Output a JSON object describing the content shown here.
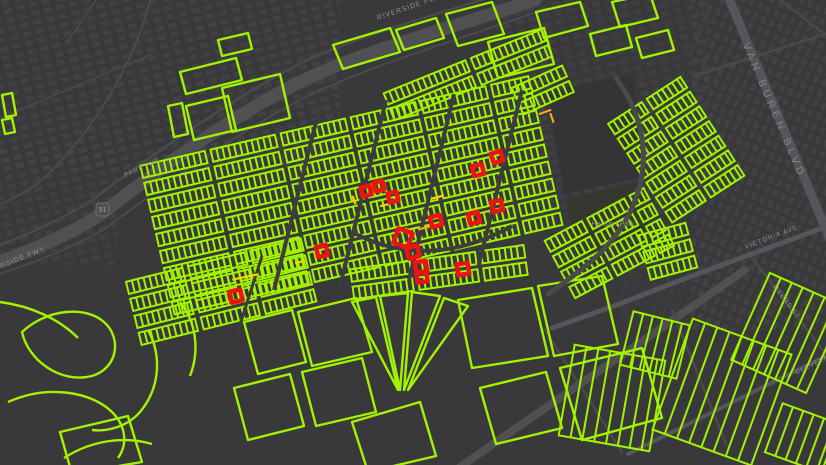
{
  "map": {
    "width": 826,
    "height": 465,
    "colors": {
      "bg": "#39393b",
      "road": "#4a4a4c",
      "freeway": "#505053",
      "arterial": "#55555a",
      "dark_street": "#3d3d3f",
      "building": "#444447",
      "school_patch": "#343436",
      "park_patch": "#36382f",
      "green": "#a2f300",
      "red": "#ee1212",
      "yellow": "#ffd400",
      "orange": "#ffa31a",
      "label": "#8f8f91",
      "label_road_major": "#86868a",
      "label_park": "#87907f",
      "shield_fill": "#4f4f52",
      "shield_stroke": "#6e6e71",
      "shield_text": "#a0a0a2"
    },
    "building_zones": [
      {
        "x": 0,
        "y": 0,
        "w": 340,
        "h": 170,
        "p": 1,
        "o": 0.75
      },
      {
        "x": 0,
        "y": 150,
        "w": 118,
        "h": 115,
        "p": 1,
        "o": 0.6
      },
      {
        "x": 495,
        "y": 0,
        "w": 215,
        "h": 125,
        "p": 1,
        "o": 0.5
      },
      {
        "x": 540,
        "y": 85,
        "w": 125,
        "h": 130,
        "p": 1,
        "o": 0.5
      },
      {
        "x": 692,
        "y": 0,
        "w": 134,
        "h": 330,
        "p": 2,
        "o": 0.7
      },
      {
        "x": 620,
        "y": 240,
        "w": 100,
        "h": 90,
        "p": 2,
        "o": 0.4
      }
    ],
    "dark_patches": [
      {
        "pts": "548,92 632,74 648,176 564,194",
        "c": "school_patch"
      },
      {
        "pts": "566,198 640,182 652,240 578,256",
        "c": "park_patch"
      }
    ],
    "roads": [
      {
        "name": "riverside-fwy",
        "d": "M535,0 C460,25 360,52 300,82 C240,112 170,160 100,215 C60,240 25,252 0,262",
        "w": 13,
        "c": "freeway"
      },
      {
        "name": "park-ave",
        "d": "M520,-12 C450,10 350,38 295,66 C238,96 165,145 92,200 C55,224 22,236 0,245",
        "w": 2.5,
        "c": "road"
      },
      {
        "name": "fwy-south-frontage",
        "d": "M548,8 C470,36 368,66 308,96 C248,126 178,174 106,228 C66,252 28,264 0,274",
        "w": 2,
        "c": "road"
      },
      {
        "name": "van-buren-blvd",
        "d": "M727,-6 L838,258",
        "w": 9,
        "c": "arterial"
      },
      {
        "name": "victoria-ave",
        "d": "M838,222 C770,248 700,272 640,296 C610,308 580,318 552,328",
        "w": 5,
        "c": "arterial"
      },
      {
        "name": "myers-st",
        "d": "M752,258 L838,370",
        "w": 2.5,
        "c": "road"
      },
      {
        "name": "cleveland-ave",
        "d": "M628,454 L838,350",
        "w": 4,
        "c": "arterial"
      },
      {
        "name": "canal-road",
        "d": "M745,270 L460,467",
        "w": 8,
        "c": "freeway"
      },
      {
        "name": "minor-1",
        "d": "M0,118 L150,55",
        "w": 1.5,
        "c": "road"
      },
      {
        "name": "minor-2",
        "d": "M150,0 C136,58 100,120 56,166 C36,188 16,198 0,204",
        "w": 2,
        "c": "road"
      },
      {
        "name": "minor-3",
        "d": "M96,0 L66,44",
        "w": 1.5,
        "c": "road"
      },
      {
        "name": "minor-4",
        "d": "M694,76 L838,30",
        "w": 2.5,
        "c": "road"
      },
      {
        "name": "minor-5",
        "d": "M780,0 L838,44",
        "w": 2,
        "c": "road"
      },
      {
        "name": "minor-6",
        "d": "M545,330 L622,452",
        "w": 2.5,
        "c": "road"
      },
      {
        "name": "minor-7",
        "d": "M672,310 L726,444",
        "w": 2.5,
        "c": "road"
      }
    ],
    "green": {
      "curves": [
        "M22,332 C48,308 86,306 104,322 C122,338 118,368 92,376 C60,384 28,360 22,332 Z",
        "M0,302 C30,306 58,318 78,338",
        "M8,402 C48,384 92,392 112,412 C126,426 128,444 118,458",
        "M64,458 C92,440 124,436 152,444",
        "M148,330 C162,356 160,388 140,412 C128,426 108,432 92,430",
        "M180,302 C196,322 200,350 190,376"
      ],
      "plots": [
        "333,45 390,28 400,52 343,69",
        "396,30 436,18 444,38 404,50",
        "446,14 492,2 504,34 458,46",
        "488,42 544,28 554,64 498,78",
        "536,12 580,2 588,26 544,38",
        "590,34 626,25 632,47 596,56",
        "612,2 650,-6 658,18 620,27",
        "636,38 668,30 674,50 642,58",
        "222,88 280,74 290,118 232,132",
        "180,72 236,58 242,80 186,94",
        "218,40 248,33 252,49 222,56",
        "186,106 228,96 236,130 194,140",
        "168,106 182,103 188,134 174,137",
        "2,95 12,93 16,115 6,117",
        "2,120 12,118 15,132 5,134",
        "352,302 376,297 398,390",
        "380,296 408,293 400,390",
        "412,292 440,296 404,390",
        "444,298 468,306 408,390",
        "458,300 532,288 548,356 472,368",
        "538,286 602,276 618,344 554,356",
        "560,368 642,348 662,418 582,440",
        "480,388 546,372 562,428 496,444",
        "298,312 356,298 372,352 312,366",
        "244,322 292,310 306,362 258,374",
        "302,372 362,358 376,412 316,426",
        "234,388 290,374 304,426 248,440",
        "352,422 420,402 436,456 368,472",
        "60,432 128,416 142,462 72,474"
      ],
      "combs": [
        {
          "x": 470,
          "y": 80,
          "w": 170,
          "h": 40,
          "a": -22,
          "rh": 12,
          "rg": 6,
          "sl": 88
        },
        {
          "x": 545,
          "y": 95,
          "w": 55,
          "h": 40,
          "a": -24,
          "rh": 12,
          "rg": 6,
          "sl": 55
        },
        {
          "x": 352,
          "y": 198,
          "w": 398,
          "h": 158,
          "a": -13,
          "rh": 12.5,
          "rg": 6,
          "sl": 66
        },
        {
          "x": 222,
          "y": 295,
          "w": 180,
          "h": 72,
          "a": -14,
          "rh": 12.5,
          "rg": 6,
          "sl": 58
        },
        {
          "x": 440,
          "y": 280,
          "w": 175,
          "h": 46,
          "a": -8,
          "rh": 12.5,
          "rg": 6,
          "sl": 60
        },
        {
          "x": 612,
          "y": 248,
          "w": 112,
          "h": 76,
          "a": -28,
          "rh": 12.5,
          "rg": 6,
          "sl": 42
        },
        {
          "x": 680,
          "y": 150,
          "w": 92,
          "h": 122,
          "a": -33,
          "rh": 12.5,
          "rg": 6,
          "sl": 40
        },
        {
          "x": 674,
          "y": 258,
          "w": 56,
          "h": 62,
          "a": -15,
          "rh": 12,
          "rg": 6,
          "sl": 48
        }
      ],
      "strips": [
        {
          "x": 612,
          "y": 398,
          "w": 92,
          "h": 92,
          "a": 10,
          "rg": 12
        },
        {
          "x": 722,
          "y": 392,
          "w": 105,
          "h": 118,
          "a": 20,
          "rg": 13
        },
        {
          "x": 788,
          "y": 333,
          "w": 82,
          "h": 95,
          "a": 24,
          "rg": 12
        },
        {
          "x": 655,
          "y": 345,
          "w": 58,
          "h": 55,
          "a": 14,
          "rg": 10
        },
        {
          "x": 802,
          "y": 438,
          "w": 60,
          "h": 52,
          "a": 20,
          "rg": 11
        }
      ]
    },
    "cross_streets": [
      {
        "d": "M320,106 L274,290",
        "w": 4
      },
      {
        "d": "M386,100 L340,286",
        "w": 4
      },
      {
        "d": "M454,94 L409,280",
        "w": 4
      },
      {
        "d": "M522,90 L478,268",
        "w": 4
      },
      {
        "d": "M352,232 C400,258 455,258 512,226",
        "w": 4
      },
      {
        "d": "M262,256 L237,334",
        "w": 3
      }
    ],
    "over_roads": [
      {
        "name": "central-curve-road",
        "d": "M616,78 C648,122 650,168 632,208 C616,244 586,268 548,294",
        "w": 5,
        "c": "road"
      }
    ],
    "accents": [
      {
        "x": 545,
        "y": 112,
        "l": 13,
        "a": -20,
        "c": "orange"
      },
      {
        "x": 552,
        "y": 118,
        "l": 10,
        "a": 70,
        "c": "orange"
      },
      {
        "x": 245,
        "y": 277,
        "l": 26,
        "a": -12,
        "c": "yellow"
      },
      {
        "x": 438,
        "y": 197,
        "l": 12,
        "a": -14,
        "c": "yellow"
      },
      {
        "x": 424,
        "y": 228,
        "l": 12,
        "a": -14,
        "c": "orange"
      },
      {
        "x": 385,
        "y": 205,
        "l": 10,
        "a": -14,
        "c": "yellow"
      },
      {
        "x": 354,
        "y": 200,
        "l": 9,
        "a": 70,
        "c": "yellow"
      },
      {
        "x": 408,
        "y": 232,
        "l": 10,
        "a": 60,
        "c": "orange"
      },
      {
        "x": 300,
        "y": 262,
        "l": 10,
        "a": -14,
        "c": "yellow"
      }
    ],
    "red_parcels": [
      {
        "x": 366,
        "y": 191,
        "s": 9,
        "a": -14
      },
      {
        "x": 379,
        "y": 186,
        "s": 9,
        "a": -14
      },
      {
        "x": 393,
        "y": 197,
        "s": 9,
        "a": -14
      },
      {
        "x": 436,
        "y": 221,
        "s": 10,
        "a": -14
      },
      {
        "x": 474,
        "y": 218,
        "s": 10,
        "a": -14
      },
      {
        "x": 497,
        "y": 206,
        "s": 10,
        "a": -14
      },
      {
        "x": 478,
        "y": 170,
        "s": 10,
        "a": -14
      },
      {
        "x": 497,
        "y": 157,
        "s": 10,
        "a": -20
      },
      {
        "x": 403,
        "y": 238,
        "s": 15,
        "a": 20
      },
      {
        "x": 413,
        "y": 252,
        "s": 11,
        "a": -14
      },
      {
        "x": 421,
        "y": 267,
        "s": 11,
        "a": -10
      },
      {
        "x": 422,
        "y": 277,
        "s": 10,
        "a": -8
      },
      {
        "x": 463,
        "y": 269,
        "s": 11,
        "a": -10
      },
      {
        "x": 322,
        "y": 251,
        "s": 10,
        "a": -14
      },
      {
        "x": 236,
        "y": 296,
        "s": 11,
        "a": -14
      }
    ],
    "labels": [
      {
        "name": "label-riverside-fwy-upper",
        "text": "RIVERSIDE FWY",
        "x": 410,
        "y": 9,
        "a": -19,
        "s": 7,
        "ls": 1,
        "c": "label"
      },
      {
        "name": "label-riverside-fwy-lower",
        "text": "RIVERSIDE FWY",
        "x": 14,
        "y": 263,
        "a": -22,
        "s": 7,
        "ls": 1,
        "c": "label"
      },
      {
        "name": "label-park-ave",
        "text": "PARK AVE",
        "x": 143,
        "y": 169,
        "a": -25,
        "s": 6.5,
        "ls": 1,
        "c": "label"
      },
      {
        "name": "label-van-buren-blvd",
        "text": "VAN BUREN BLVD",
        "x": 771,
        "y": 112,
        "a": 67,
        "s": 10.5,
        "ls": 4,
        "c": "label_road_major"
      },
      {
        "name": "label-hansen-park",
        "text": "Hansen Park",
        "x": 613,
        "y": 226,
        "a": 0,
        "s": 7.5,
        "ls": 0,
        "c": "label_park"
      },
      {
        "name": "label-victoria-ave",
        "text": "VICTORIA AVE",
        "x": 772,
        "y": 239,
        "a": -21,
        "s": 6.5,
        "ls": 1,
        "c": "label"
      },
      {
        "name": "label-myers-st",
        "text": "MYERS ST",
        "x": 785,
        "y": 303,
        "a": 53,
        "s": 6.5,
        "ls": 1,
        "c": "label"
      },
      {
        "name": "label-cleveland-ave",
        "text": "CLEVELAND AVE",
        "x": 826,
        "y": 360,
        "a": -26,
        "s": 6.5,
        "ls": 1,
        "c": "label"
      }
    ],
    "shield": {
      "x": 96,
      "y": 203,
      "w": 13,
      "h": 13,
      "text": "91"
    }
  }
}
